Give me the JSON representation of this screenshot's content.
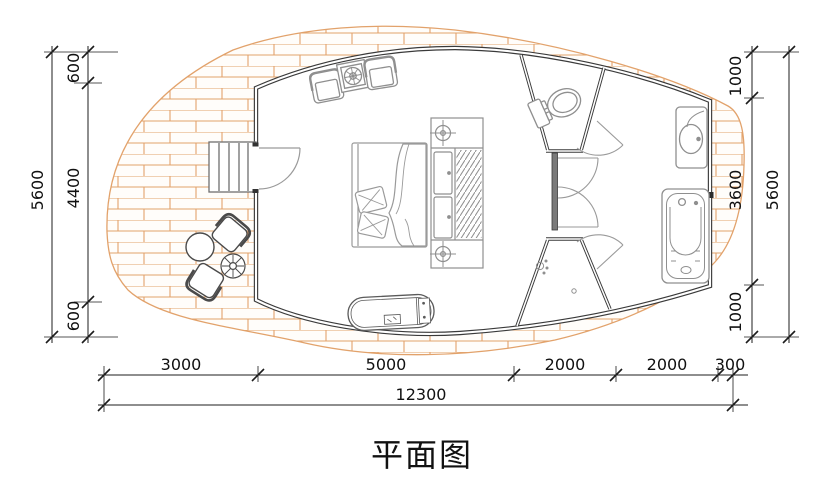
{
  "title": "平面图",
  "dims": {
    "left": {
      "outer": "5600",
      "segs": [
        "600",
        "4400",
        "600"
      ]
    },
    "right": {
      "outer": "5600",
      "segs": [
        "1000",
        "3600",
        "1000"
      ]
    },
    "bottom": {
      "total": "12300",
      "segs": [
        "3000",
        "5000",
        "2000",
        "2000",
        "300"
      ]
    }
  },
  "colors": {
    "wall": "#3a3a3a",
    "furniture": "#8f8f8f",
    "outdoor_furniture": "#4a4a4a",
    "deck_line": "#e2a26b",
    "deck_fill": "#fffdfa",
    "dimension": "#1c1c1c"
  },
  "fixtures": [
    "stairs",
    "entry-door",
    "armchair",
    "plant-side-table",
    "armchair",
    "double-bed",
    "pillows",
    "blanket",
    "wardrobe-with-hangers",
    "bedside-lamp",
    "bedside-lamp",
    "chaise-lounge",
    "toilet",
    "wash-basin",
    "bathtub",
    "shower-head",
    "floor-drain",
    "outdoor-round-table",
    "outdoor-chair",
    "outdoor-chair",
    "flower-stand",
    "wood-deck",
    "interior-doors"
  ]
}
